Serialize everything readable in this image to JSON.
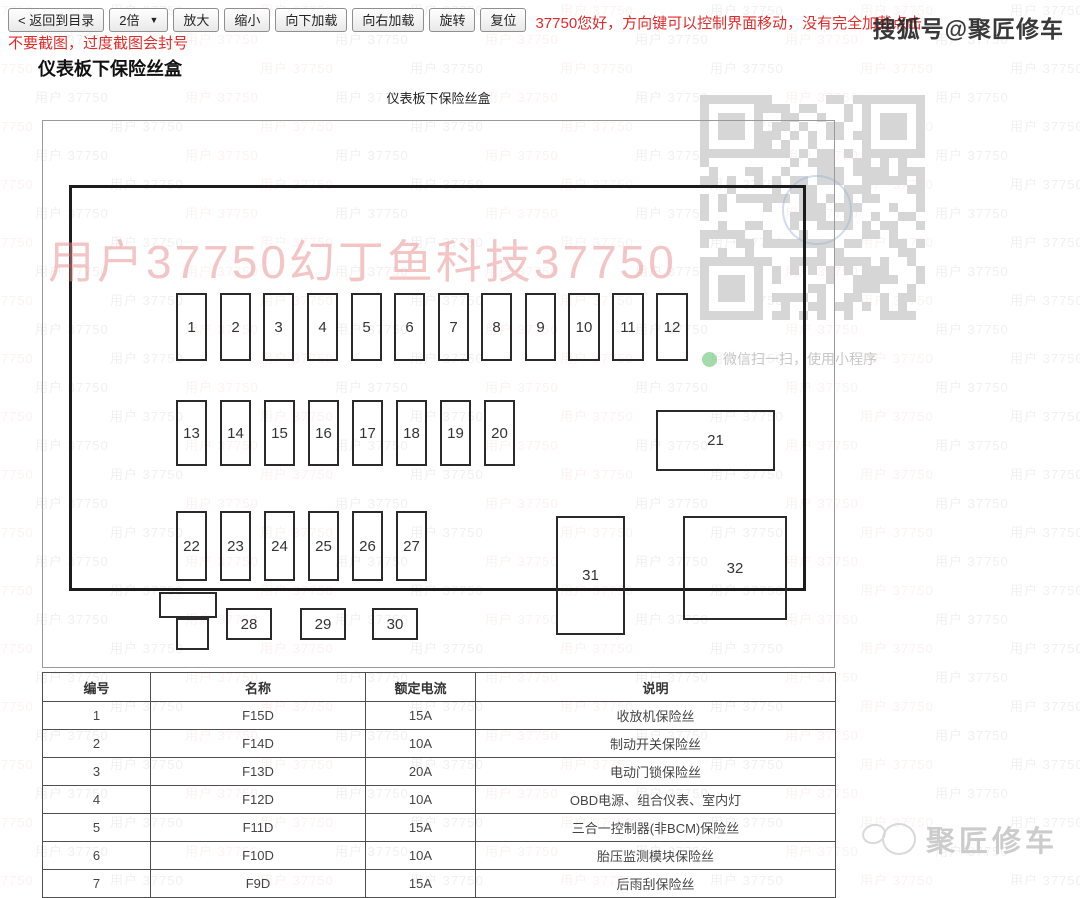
{
  "toolbar": {
    "back_button": "< 返回到目录",
    "zoom_select": {
      "value": "2倍",
      "arrow": "▼"
    },
    "buttons": [
      "放大",
      "缩小",
      "向下加载",
      "向右加载",
      "旋转",
      "复位"
    ],
    "notice": "37750您好，方向键可以控制界面移动，没有完全加载点击",
    "warning": "不要截图，过度截图会封号",
    "notice_color": "#e02b2b"
  },
  "page": {
    "heading": "仪表板下保险丝盒",
    "diagram_caption": "仪表板下保险丝盒"
  },
  "overlays": {
    "sohu_badge": "搜狐号@聚匠修车",
    "corner_logo": "聚匠修车",
    "pink_watermark": "用户37750幻丁鱼科技37750",
    "pink_color": "rgba(231,140,140,0.5)",
    "tile_text": "用户 37750",
    "tile_gray": "rgba(150,140,140,0.13)",
    "tile_pink": "rgba(220,130,130,0.10)",
    "qr_caption": "微信扫一扫，使用小程序",
    "wechat_icon_color": "#58be6a"
  },
  "diagram": {
    "fuses": [
      {
        "label": "1",
        "x": 104,
        "y": 105,
        "w": 27,
        "h": 64
      },
      {
        "label": "2",
        "x": 148,
        "y": 105,
        "w": 27,
        "h": 64
      },
      {
        "label": "3",
        "x": 191,
        "y": 105,
        "w": 27,
        "h": 64
      },
      {
        "label": "4",
        "x": 235,
        "y": 105,
        "w": 27,
        "h": 64
      },
      {
        "label": "5",
        "x": 279,
        "y": 105,
        "w": 27,
        "h": 64
      },
      {
        "label": "6",
        "x": 322,
        "y": 105,
        "w": 27,
        "h": 64
      },
      {
        "label": "7",
        "x": 366,
        "y": 105,
        "w": 27,
        "h": 64
      },
      {
        "label": "8",
        "x": 409,
        "y": 105,
        "w": 27,
        "h": 64
      },
      {
        "label": "9",
        "x": 453,
        "y": 105,
        "w": 27,
        "h": 64
      },
      {
        "label": "10",
        "x": 496,
        "y": 105,
        "w": 28,
        "h": 64
      },
      {
        "label": "11",
        "x": 540,
        "y": 105,
        "w": 28,
        "h": 64
      },
      {
        "label": "12",
        "x": 584,
        "y": 105,
        "w": 28,
        "h": 64
      },
      {
        "label": "13",
        "x": 104,
        "y": 212,
        "w": 27,
        "h": 62
      },
      {
        "label": "14",
        "x": 148,
        "y": 212,
        "w": 27,
        "h": 62
      },
      {
        "label": "15",
        "x": 192,
        "y": 212,
        "w": 27,
        "h": 62
      },
      {
        "label": "16",
        "x": 236,
        "y": 212,
        "w": 27,
        "h": 62
      },
      {
        "label": "17",
        "x": 280,
        "y": 212,
        "w": 27,
        "h": 62
      },
      {
        "label": "18",
        "x": 324,
        "y": 212,
        "w": 27,
        "h": 62
      },
      {
        "label": "19",
        "x": 368,
        "y": 212,
        "w": 27,
        "h": 62
      },
      {
        "label": "20",
        "x": 412,
        "y": 212,
        "w": 27,
        "h": 62
      },
      {
        "label": "21",
        "x": 584,
        "y": 222,
        "w": 115,
        "h": 57
      },
      {
        "label": "22",
        "x": 104,
        "y": 323,
        "w": 27,
        "h": 66
      },
      {
        "label": "23",
        "x": 148,
        "y": 323,
        "w": 27,
        "h": 66
      },
      {
        "label": "24",
        "x": 192,
        "y": 323,
        "w": 27,
        "h": 66
      },
      {
        "label": "25",
        "x": 236,
        "y": 323,
        "w": 27,
        "h": 66
      },
      {
        "label": "26",
        "x": 280,
        "y": 323,
        "w": 27,
        "h": 66
      },
      {
        "label": "27",
        "x": 324,
        "y": 323,
        "w": 27,
        "h": 66
      },
      {
        "label": "",
        "x": 87,
        "y": 404,
        "w": 54,
        "h": 22
      },
      {
        "label": "",
        "x": 104,
        "y": 430,
        "w": 29,
        "h": 28
      },
      {
        "label": "28",
        "x": 154,
        "y": 420,
        "w": 42,
        "h": 28
      },
      {
        "label": "29",
        "x": 228,
        "y": 420,
        "w": 42,
        "h": 28
      },
      {
        "label": "30",
        "x": 300,
        "y": 420,
        "w": 42,
        "h": 28
      },
      {
        "label": "31",
        "x": 484,
        "y": 328,
        "w": 65,
        "h": 115
      },
      {
        "label": "32",
        "x": 611,
        "y": 328,
        "w": 100,
        "h": 100
      }
    ]
  },
  "table": {
    "headers": [
      "编号",
      "名称",
      "额定电流",
      "说明"
    ],
    "rows": [
      [
        "1",
        "F15D",
        "15A",
        "收放机保险丝"
      ],
      [
        "2",
        "F14D",
        "10A",
        "制动开关保险丝"
      ],
      [
        "3",
        "F13D",
        "20A",
        "电动门锁保险丝"
      ],
      [
        "4",
        "F12D",
        "10A",
        "OBD电源、组合仪表、室内灯"
      ],
      [
        "5",
        "F11D",
        "15A",
        "三合一控制器(非BCM)保险丝"
      ],
      [
        "6",
        "F10D",
        "10A",
        "胎压监测模块保险丝"
      ],
      [
        "7",
        "F9D",
        "15A",
        "后雨刮保险丝"
      ]
    ]
  }
}
